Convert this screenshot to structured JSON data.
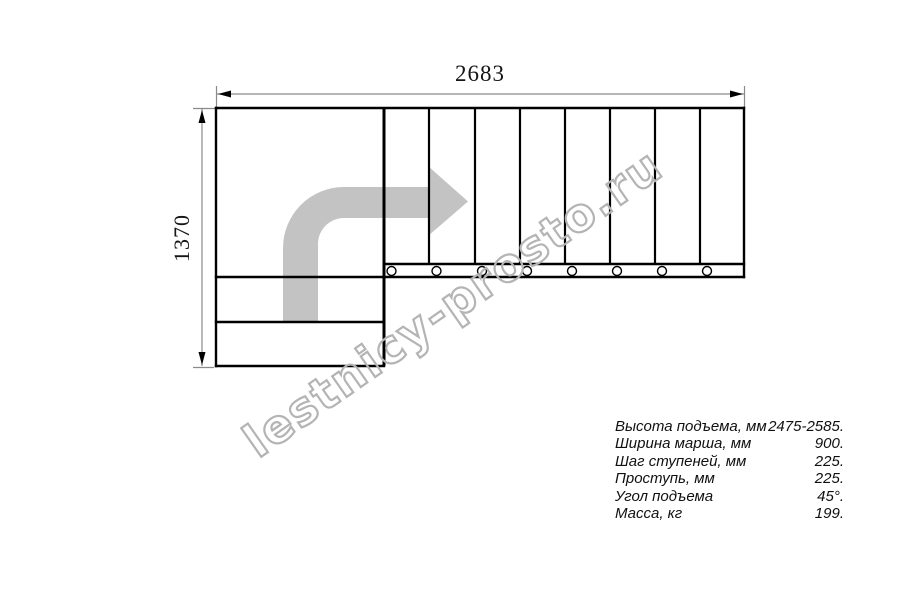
{
  "drawing": {
    "type": "staircase-plan-top-view",
    "top_dimension_mm": "2683",
    "left_dimension_mm": "1370",
    "upper_flight_steps": 8,
    "lower_flight_steps": 2,
    "mount_hole_markers": 8,
    "direction_arrow": "up-then-right-turn",
    "line_color": "#000000",
    "dimension_line_color": "#8a8a8a",
    "arrow_fill_color": "#c3c3c3"
  },
  "watermark": {
    "text": "lestnicy-prosto.ru",
    "color": "#b4b4b4"
  },
  "specs": {
    "rows": [
      {
        "label": "Высота подъема, мм",
        "value": "2475-2585."
      },
      {
        "label": "Ширина марша, мм",
        "value": "900."
      },
      {
        "label": "Шаг ступеней, мм",
        "value": "225."
      },
      {
        "label": "Проступь, мм",
        "value": "225."
      },
      {
        "label": "Угол подъема",
        "value": "45°."
      },
      {
        "label": "Масса, кг",
        "value": "199."
      }
    ]
  }
}
